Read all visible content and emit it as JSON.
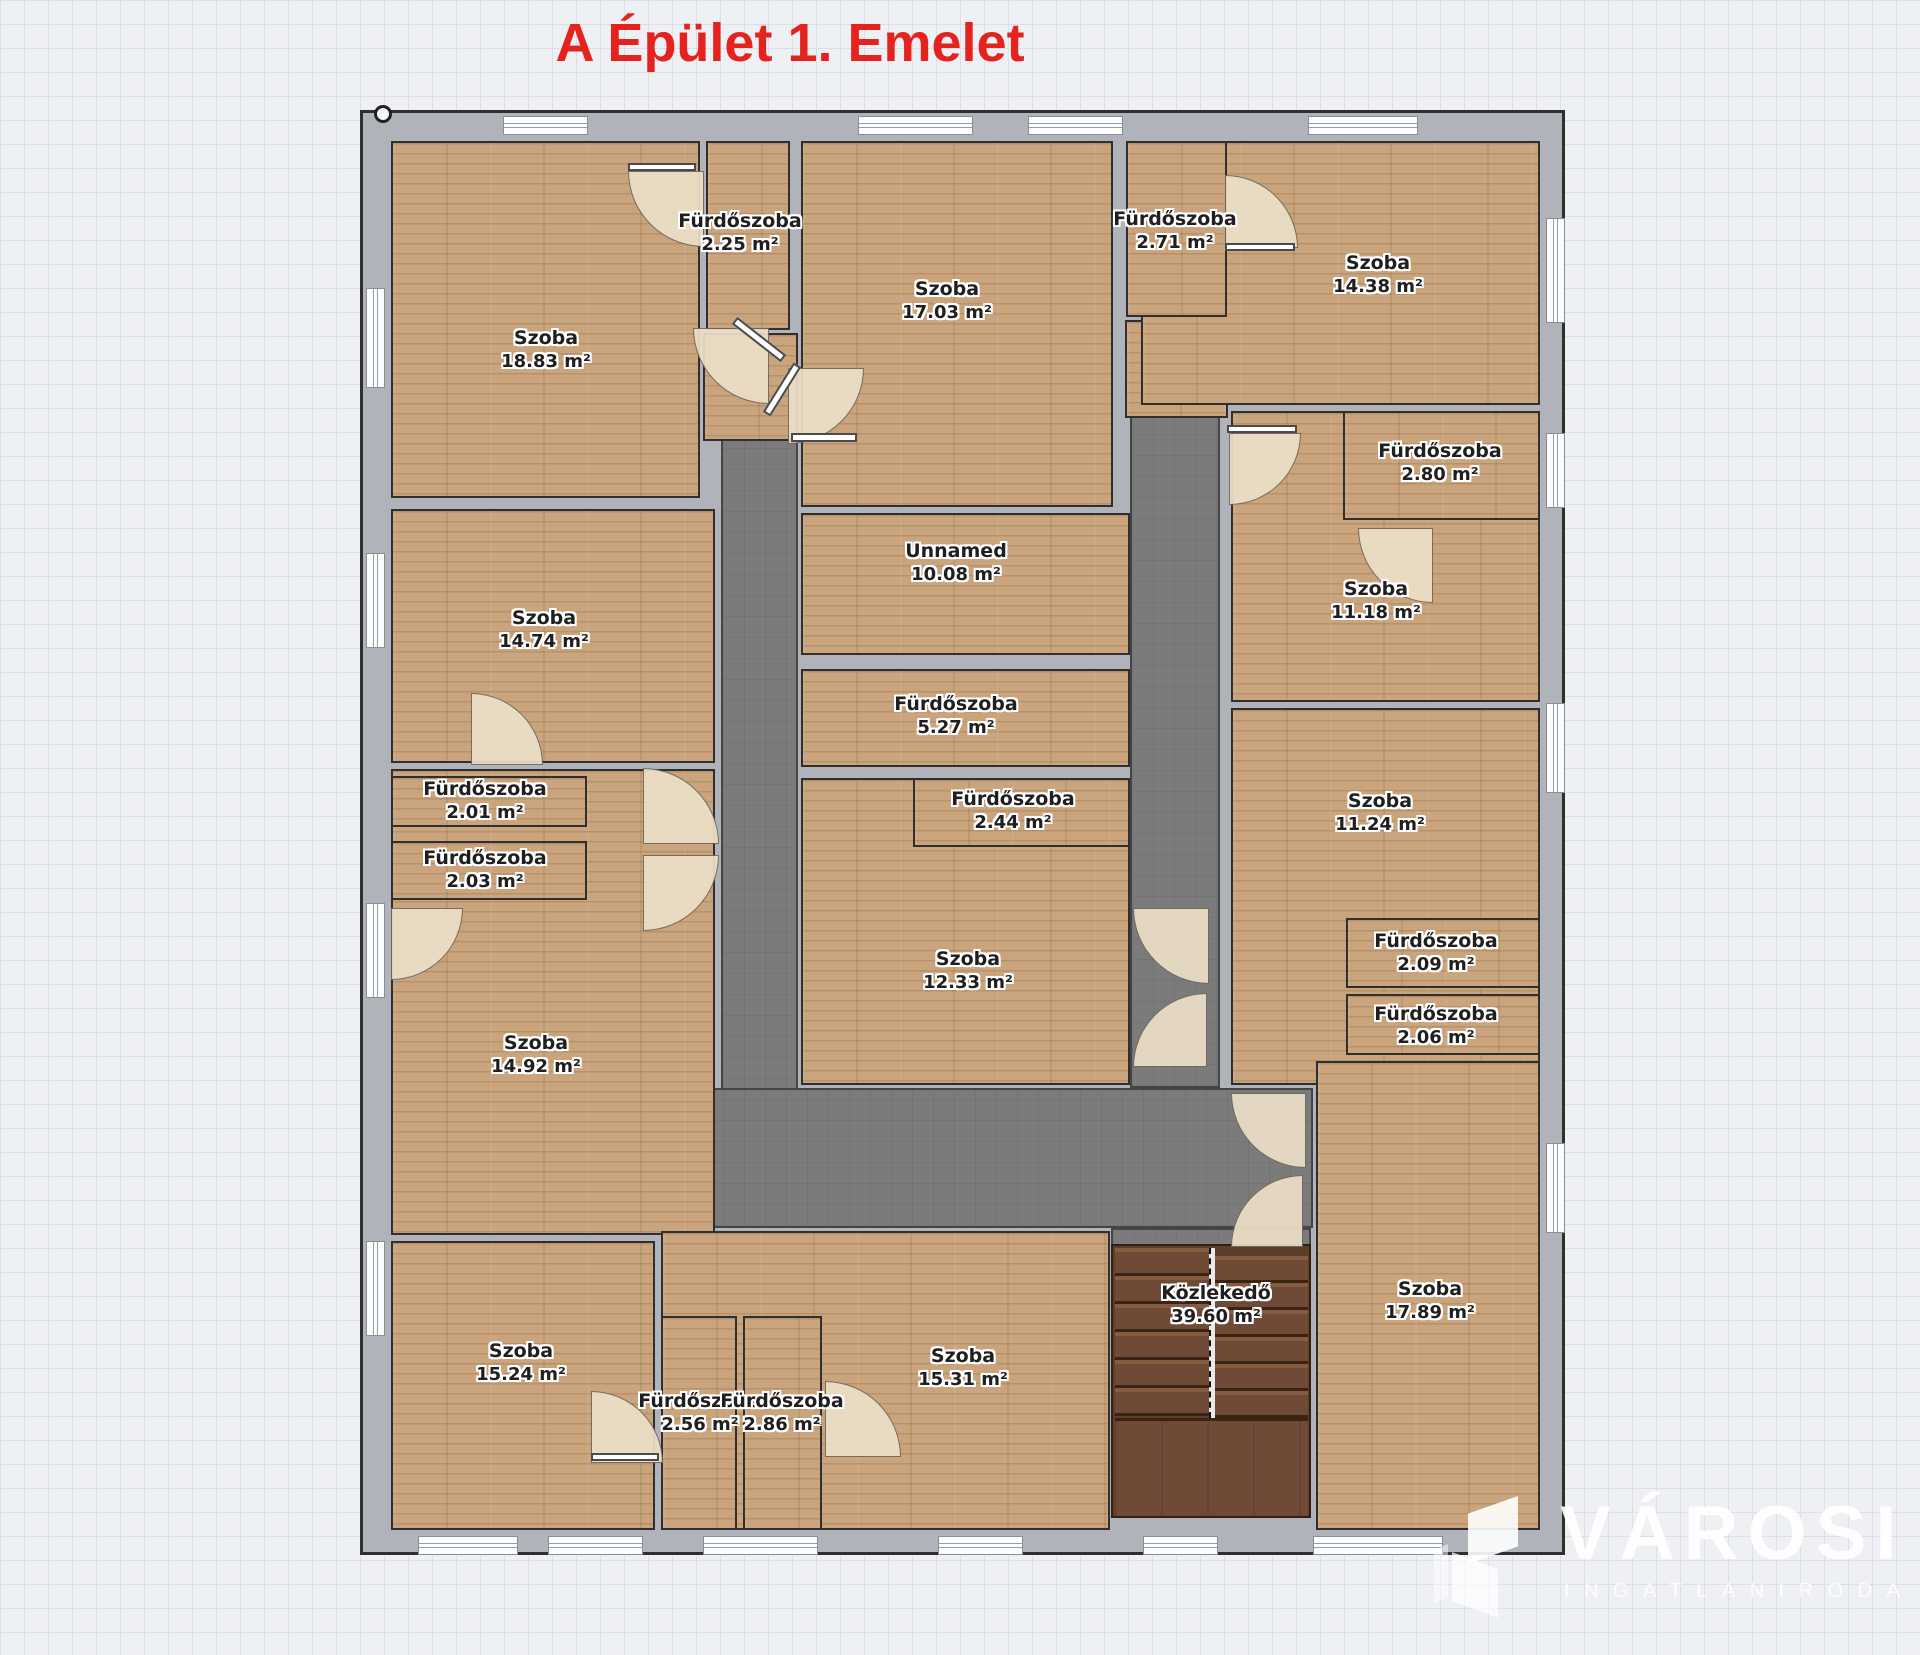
{
  "title": {
    "text": "A Épület 1. Emelet",
    "color": "#e4231f"
  },
  "watermark": {
    "brand": "VÁROSI",
    "subtitle": "INGATLANIRODA"
  },
  "colors": {
    "wall": "#b0b3b9",
    "wall_line": "#2f2f2f",
    "wood": "#c9a47c",
    "corridor": "#7b7b7b",
    "stairs": "#6f4a36",
    "door": "#ecdfc8",
    "grid_bg": "#eef0f4",
    "grid_line": "#dcdfe6",
    "label_text": "#1f1f1f"
  },
  "floorplan": {
    "rooms": [
      {
        "id": "szoba-18-83",
        "name": "Szoba",
        "area": "18.83 m²",
        "rect": [
          25,
          25,
          315,
          363
        ],
        "label": [
          183,
          237
        ]
      },
      {
        "id": "furdoszoba-2-25",
        "name": "Fürdőszoba",
        "area": "2.25 m²",
        "rect": [
          340,
          25,
          90,
          195
        ],
        "label": [
          377,
          120
        ]
      },
      {
        "id": "szoba-17-03",
        "name": "Szoba",
        "area": "17.03 m²",
        "rect": [
          435,
          25,
          318,
          372
        ],
        "label": [
          584,
          188
        ]
      },
      {
        "id": "szoba-14-38",
        "name": "Szoba",
        "area": "14.38 m²",
        "rect": [
          775,
          25,
          405,
          270
        ],
        "label": [
          1015,
          162
        ]
      },
      {
        "id": "furdoszoba-2-71",
        "name": "Fürdőszoba",
        "area": "2.71 m²",
        "rect": [
          760,
          25,
          107,
          182
        ],
        "label": [
          812,
          118
        ]
      },
      {
        "id": "szoba-11-18",
        "name": "Szoba",
        "area": "11.18 m²",
        "rect": [
          865,
          295,
          315,
          297
        ],
        "label": [
          1013,
          488
        ]
      },
      {
        "id": "furdoszoba-2-80",
        "name": "Fürdőszoba",
        "area": "2.80 m²",
        "rect": [
          977,
          295,
          203,
          115
        ],
        "label": [
          1077,
          350
        ]
      },
      {
        "id": "szoba-11-24",
        "name": "Szoba",
        "area": "11.24 m²",
        "rect": [
          865,
          592,
          315,
          383
        ],
        "label": [
          1017,
          700
        ]
      },
      {
        "id": "furdoszoba-2-09",
        "name": "Fürdőszoba",
        "area": "2.09 m²",
        "rect": [
          980,
          802,
          200,
          76
        ],
        "label": [
          1073,
          840
        ]
      },
      {
        "id": "furdoszoba-2-06",
        "name": "Fürdőszoba",
        "area": "2.06 m²",
        "rect": [
          980,
          878,
          200,
          67
        ],
        "label": [
          1073,
          913
        ]
      },
      {
        "id": "szoba-17-89",
        "name": "Szoba",
        "area": "17.89 m²",
        "rect": [
          950,
          945,
          230,
          475
        ],
        "label": [
          1067,
          1188
        ]
      },
      {
        "id": "szoba-14-74",
        "name": "Szoba",
        "area": "14.74 m²",
        "rect": [
          25,
          393,
          330,
          260
        ],
        "label": [
          181,
          517
        ]
      },
      {
        "id": "szoba-14-92",
        "name": "Szoba",
        "area": "14.92 m²",
        "rect": [
          25,
          653,
          330,
          472
        ],
        "label": [
          173,
          942
        ]
      },
      {
        "id": "furdoszoba-2-01",
        "name": "Fürdőszoba",
        "area": "2.01 m²",
        "rect": [
          25,
          660,
          202,
          57
        ],
        "label": [
          122,
          688
        ]
      },
      {
        "id": "furdoszoba-2-03",
        "name": "Fürdőszoba",
        "area": "2.03 m²",
        "rect": [
          25,
          725,
          202,
          65
        ],
        "label": [
          122,
          757
        ]
      },
      {
        "id": "unnamed-10-08",
        "name": "Unnamed",
        "area": "10.08 m²",
        "rect": [
          435,
          397,
          335,
          148
        ],
        "label": [
          593,
          450
        ]
      },
      {
        "id": "furdoszoba-5-27",
        "name": "Fürdőszoba",
        "area": "5.27 m²",
        "rect": [
          435,
          553,
          335,
          104
        ],
        "label": [
          593,
          603
        ]
      },
      {
        "id": "szoba-12-33",
        "name": "Szoba",
        "area": "12.33 m²",
        "rect": [
          435,
          662,
          335,
          313
        ],
        "label": [
          605,
          858
        ]
      },
      {
        "id": "furdoszoba-2-44",
        "name": "Fürdőszoba",
        "area": "2.44 m²",
        "rect": [
          547,
          662,
          223,
          75
        ],
        "label": [
          650,
          698
        ]
      },
      {
        "id": "szoba-15-24",
        "name": "Szoba",
        "area": "15.24 m²",
        "rect": [
          25,
          1125,
          270,
          295
        ],
        "label": [
          158,
          1250
        ]
      },
      {
        "id": "szoba-15-31",
        "name": "Szoba",
        "area": "15.31 m²",
        "rect": [
          295,
          1115,
          455,
          305
        ],
        "label": [
          600,
          1255
        ]
      },
      {
        "id": "furdoszoba-2-56",
        "name": "Fürdőszoba",
        "area": "2.56 m²",
        "rect": [
          295,
          1200,
          82,
          220
        ],
        "label": [
          337,
          1300
        ]
      },
      {
        "id": "furdoszoba-2-86",
        "name": "Fürdőszoba",
        "area": "2.86 m²",
        "rect": [
          377,
          1200,
          85,
          220
        ],
        "label": [
          419,
          1300
        ]
      }
    ],
    "stairs": {
      "name": "Közlekedő",
      "area": "39.60 m²",
      "rect": [
        748,
        1131,
        200,
        274
      ],
      "label": [
        853,
        1192
      ]
    },
    "corridors": [
      [
        358,
        250,
        77,
        865
      ],
      [
        295,
        975,
        655,
        140
      ],
      [
        767,
        300,
        90,
        675
      ],
      [
        748,
        1115,
        200,
        22
      ]
    ],
    "patches": [
      [
        340,
        220,
        95,
        108
      ],
      [
        762,
        207,
        103,
        98
      ]
    ],
    "doors": [
      [
        265,
        58,
        76,
        "bl"
      ],
      [
        330,
        215,
        76,
        "bl"
      ],
      [
        425,
        255,
        76,
        "br"
      ],
      [
        862,
        62,
        73,
        "tr"
      ],
      [
        995,
        415,
        75,
        "bl"
      ],
      [
        866,
        320,
        72,
        "br"
      ],
      [
        280,
        655,
        76,
        "tr"
      ],
      [
        280,
        742,
        76,
        "br"
      ],
      [
        108,
        580,
        72,
        "tr"
      ],
      [
        28,
        795,
        72,
        "br"
      ],
      [
        770,
        795,
        76,
        "bl"
      ],
      [
        770,
        880,
        74,
        "tl"
      ],
      [
        228,
        1278,
        72,
        "tr"
      ],
      [
        462,
        1268,
        76,
        "tr"
      ],
      [
        868,
        980,
        75,
        "bl"
      ],
      [
        868,
        1062,
        72,
        "tl"
      ]
    ],
    "leafs": [
      [
        265,
        50,
        68,
        8,
        0
      ],
      [
        365,
        222,
        62,
        9,
        38
      ],
      [
        390,
        272,
        58,
        9,
        -58
      ],
      [
        428,
        320,
        66,
        9,
        0
      ],
      [
        862,
        130,
        70,
        8,
        0
      ],
      [
        864,
        312,
        70,
        8,
        0
      ],
      [
        228,
        1340,
        68,
        8,
        0
      ]
    ],
    "windows": [
      [
        140,
        3,
        85,
        19
      ],
      [
        495,
        3,
        115,
        19
      ],
      [
        665,
        3,
        95,
        19
      ],
      [
        945,
        3,
        110,
        19
      ],
      [
        55,
        1423,
        100,
        19
      ],
      [
        185,
        1423,
        95,
        19
      ],
      [
        340,
        1423,
        115,
        19
      ],
      [
        575,
        1423,
        85,
        19
      ],
      [
        780,
        1423,
        75,
        19
      ],
      [
        950,
        1423,
        130,
        19
      ],
      [
        3,
        175,
        19,
        100
      ],
      [
        3,
        440,
        19,
        95
      ],
      [
        3,
        790,
        19,
        95
      ],
      [
        3,
        1128,
        19,
        95
      ],
      [
        1183,
        105,
        19,
        105
      ],
      [
        1183,
        320,
        19,
        75
      ],
      [
        1183,
        590,
        19,
        90
      ],
      [
        1183,
        1030,
        19,
        90
      ]
    ],
    "marker": [
      11,
      -8
    ]
  }
}
